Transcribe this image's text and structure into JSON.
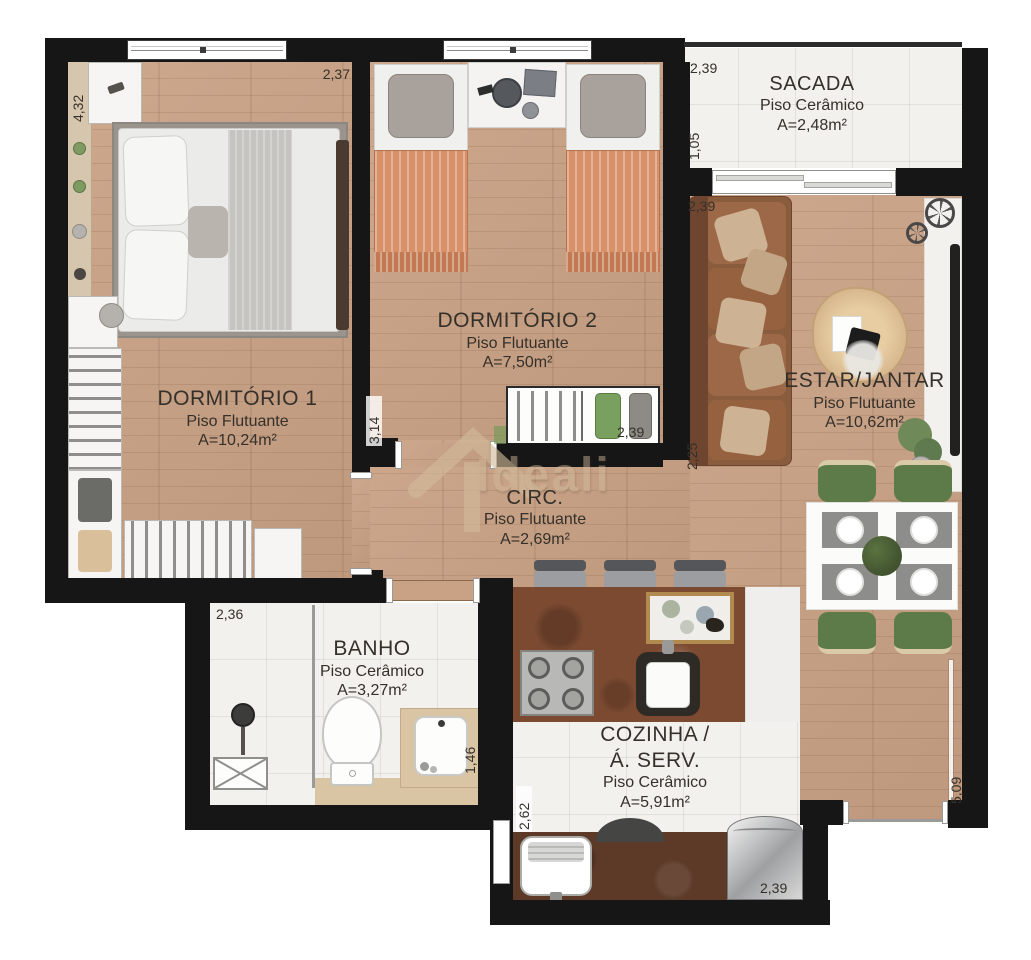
{
  "watermark": {
    "brand": "Ideali"
  },
  "rooms": {
    "dormitorio1": {
      "name": "DORMITÓRIO 1",
      "floor": "Piso Flutuante",
      "area": "A=10,24m²"
    },
    "dormitorio2": {
      "name": "DORMITÓRIO 2",
      "floor": "Piso Flutuante",
      "area": "A=7,50m²"
    },
    "sacada": {
      "name": "SACADA",
      "floor": "Piso Cerâmico",
      "area": "A=2,48m²"
    },
    "estar_jantar": {
      "name": "ESTAR/JANTAR",
      "floor": "Piso Flutuante",
      "area": "A=10,62m²"
    },
    "circulacao": {
      "name": "CIRC.",
      "floor": "Piso Flutuante",
      "area": "A=2,69m²"
    },
    "banho": {
      "name": "BANHO",
      "floor": "Piso Cerâmico",
      "area": "A=3,27m²"
    },
    "cozinha": {
      "name_line1": "COZINHA /",
      "name_line2": "Á. SERV.",
      "floor": "Piso Cerâmico",
      "area": "A=5,91m²"
    }
  },
  "dimensions": {
    "dorm1_height": "4,32",
    "dorm1_width": "2,37",
    "circ_wall": "3,14",
    "dorm2_closet": "2,39",
    "sacada_width": "2,39",
    "sacada_depth": "1,05",
    "estar_width": "2,39",
    "estar_depth": "2,25",
    "banho_width": "2,36",
    "banho_depth": "1,46",
    "servico_depth": "2,62",
    "cozinha_width": "2,39",
    "right_side": "5,09"
  },
  "colors": {
    "wood": "#c9a184",
    "ceramic": "#f2f1ed",
    "wall": "#161616",
    "rug": "#9a948d",
    "sofa": "#8a5c3e",
    "cushion": "#cdb394",
    "bed-orange": "#d89068",
    "chair-green": "#5d7b49",
    "counter-rust": "#7c4a31",
    "counter-dark": "#5d3a28",
    "beige": "#d9c4a4",
    "label": "#35302a",
    "watermark": "#d2bb9a"
  }
}
